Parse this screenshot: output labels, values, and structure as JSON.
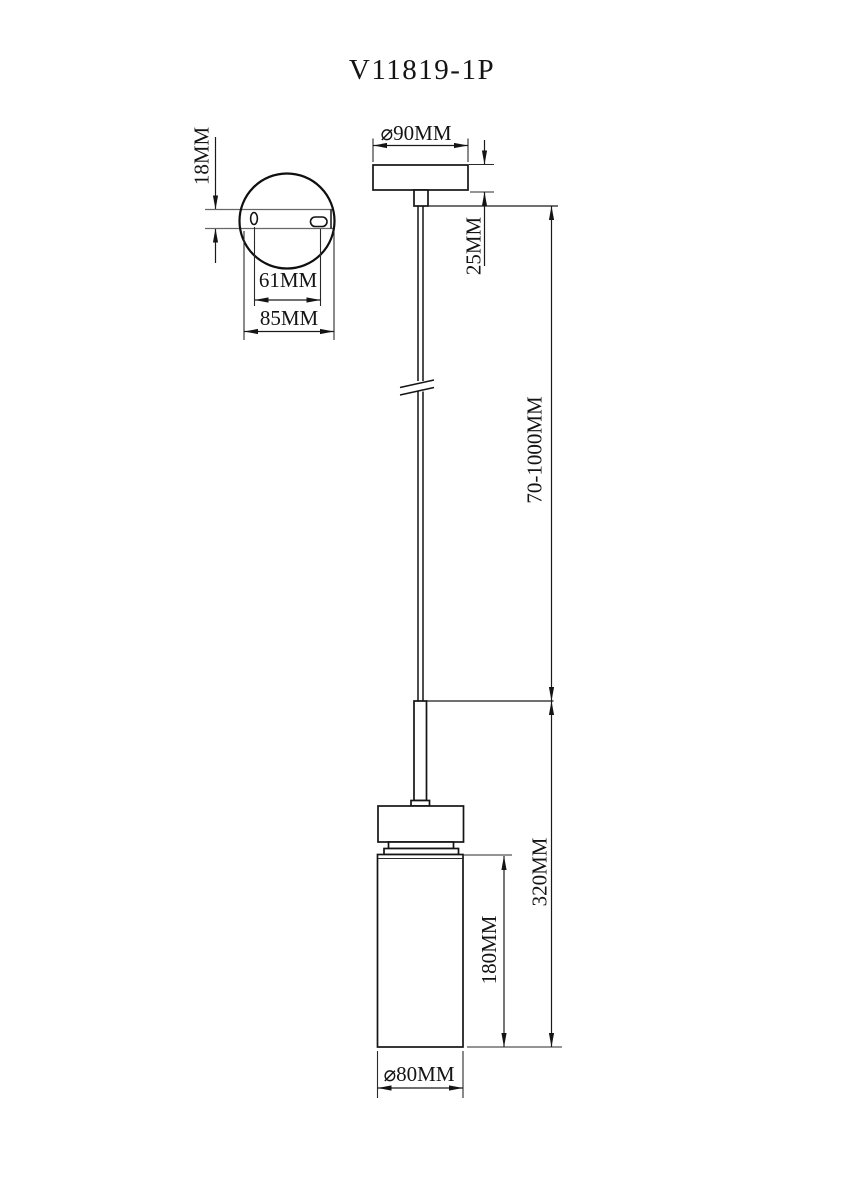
{
  "drawing": {
    "model": "V11819-1P",
    "colors": {
      "line": "#141414",
      "background": "#ffffff"
    },
    "top_view": {
      "plate_thickness": "18MM",
      "hole_spacing": "61MM",
      "plate_width": "85MM"
    },
    "side_view": {
      "canopy_diameter": "⌀90MM",
      "canopy_height": "25MM",
      "suspension_length": "70-1000MM",
      "fixture_height": "320MM",
      "shade_height": "180MM",
      "shade_diameter": "⌀80MM"
    }
  }
}
